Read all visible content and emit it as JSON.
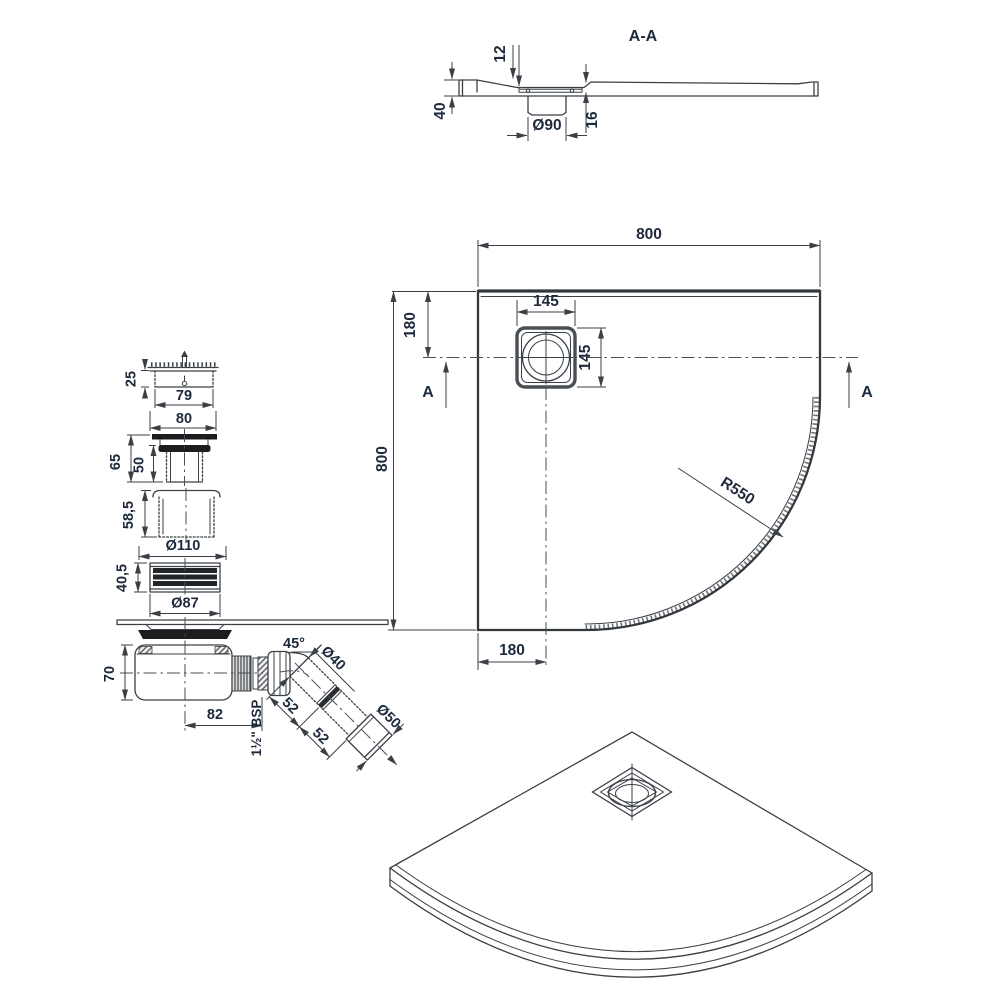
{
  "colors": {
    "line": "#3b4046",
    "text": "#1e2a3c",
    "fill_dark": "#1d1d20"
  },
  "section_view": {
    "title": "A-A",
    "depth": "12",
    "height": "40",
    "drain_dia": "Ø90",
    "recess": "16"
  },
  "plan_view": {
    "width": "800",
    "height": "800",
    "offset_top": "180",
    "offset_bottom": "180",
    "drain_w": "145",
    "drain_h": "145",
    "radius": "R550",
    "marker_left": "A",
    "marker_right": "A"
  },
  "waste_parts": {
    "grate_h": "25",
    "grate_inner": "79",
    "grate_outer": "80",
    "upper_h": "65",
    "upper_inner": "50",
    "cup_h": "58,5",
    "cup_dia": "Ø110",
    "seal_h": "40,5",
    "seal_dia": "Ø87",
    "trap_h": "70",
    "trap_len": "82",
    "elbow_angle": "45°",
    "pipe_dia": "Ø40",
    "outlet_dia": "Ø50",
    "seg1": "52",
    "seg2": "52",
    "thread": "1½\" BSP"
  }
}
